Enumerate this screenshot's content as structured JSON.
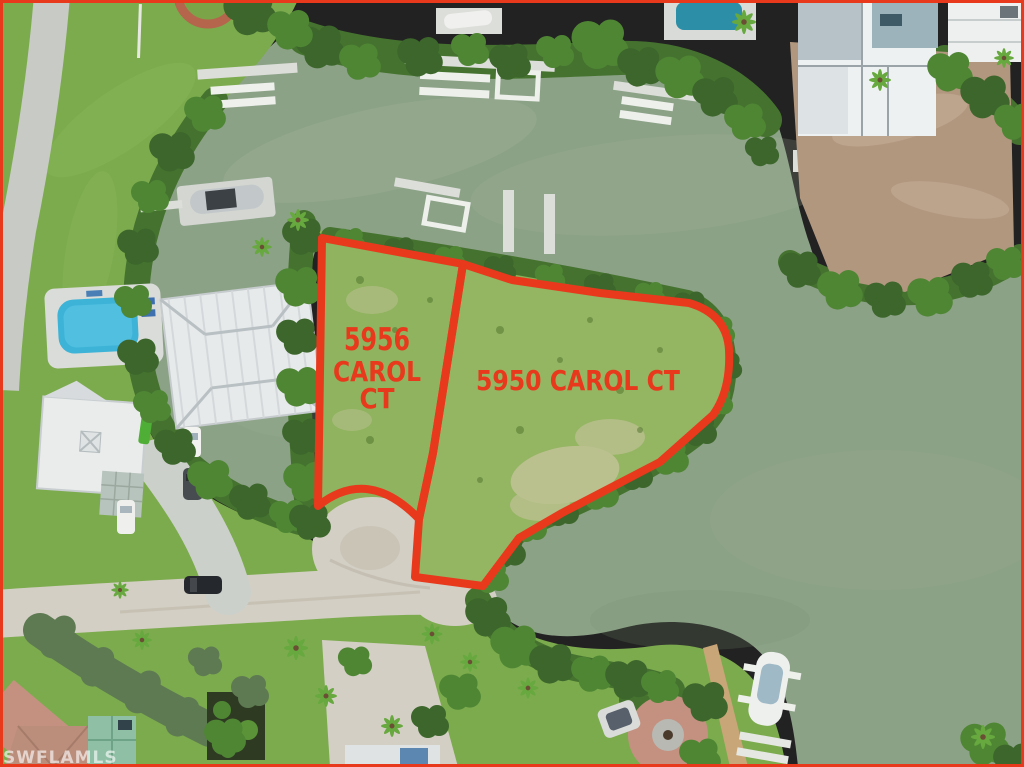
{
  "photo": {
    "description_label": "aerial lot photo",
    "watermark": "SWFLAMLS",
    "lot_left": {
      "address": "5956 CAROL CT",
      "lines": [
        "5956",
        "CAROL",
        "CT"
      ]
    },
    "lot_right": {
      "address": "5950 CAROL CT",
      "label": "5950 CAROL CT"
    },
    "colors": {
      "outline_red": "#E8391D",
      "water_green": "#8CA287",
      "grass_green": "#7CAB4E",
      "mangrove_green": "#45732F",
      "sand_road": "#D3CFC4",
      "asphalt_gray": "#C8CAC5",
      "dock_gray": "#DCDED9",
      "pool_blue": "#3DB3D7",
      "paver_pink": "#C49181",
      "dirt_brown": "#B2977F",
      "watermark_white": "rgba(255,255,255,0.62)"
    }
  }
}
